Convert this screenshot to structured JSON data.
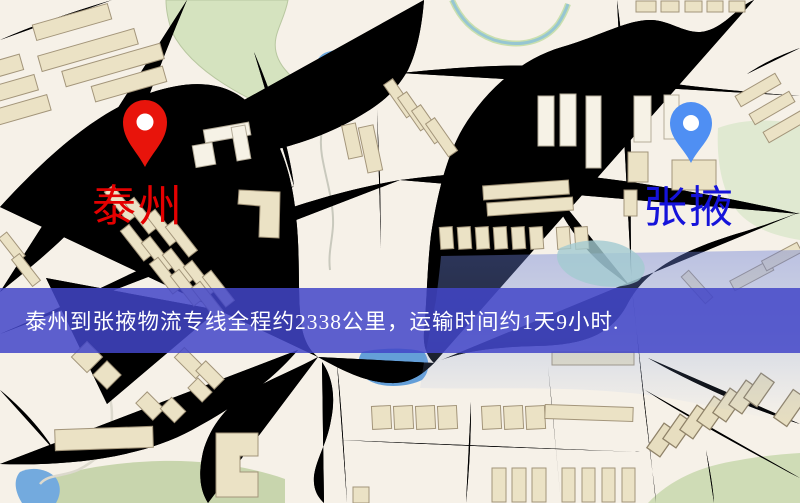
{
  "banner": {
    "text": "泰州到张掖物流专线全程约2338公里，运输时间约1天9小时.",
    "bg_color": "#4245c8",
    "text_color": "#ffffff"
  },
  "origin": {
    "name": "泰州",
    "label_color": "#e40000",
    "pin_color": "#e8140b",
    "icon": "location-pin-icon"
  },
  "destination": {
    "name": "张掖",
    "label_color": "#1513da",
    "pin_color": "#4f8ff3",
    "icon": "location-pin-icon"
  },
  "route": {
    "distance_km": "2338",
    "transit_time": "1天9小时"
  },
  "map_colors": {
    "background": "#f6f1e8",
    "road": "#f7cf74",
    "park": "#cfdfb8",
    "water": "#69a6dd",
    "railway": "#3b3b3b"
  }
}
